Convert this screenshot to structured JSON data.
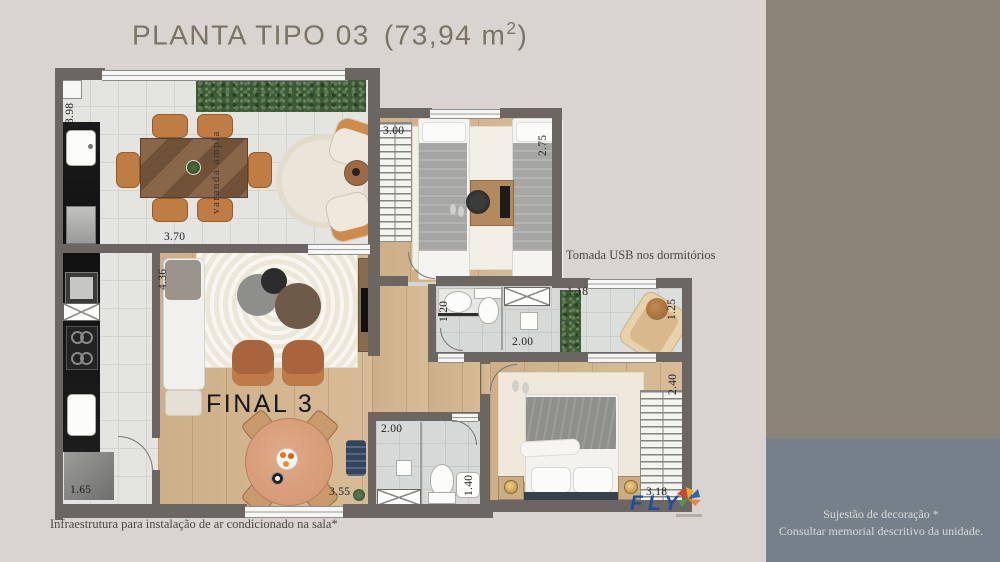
{
  "title": {
    "main": "PLANTA TIPO 03",
    "area_open": "(73,94 m",
    "area_sup": "2",
    "area_close": ")"
  },
  "plan": {
    "final_label": "FINAL 3",
    "varanda_label": "varanda ampla",
    "dimensions": {
      "balcony_height": "3.98",
      "balcony_width": "3.70",
      "bedroom2_width": "3.00",
      "bedroom2_height": "2.75",
      "living_height": "4.36",
      "bath1_height": "1.20",
      "bath1_width": "2.00",
      "terrace_width_top": "1.18",
      "terrace_height": "1.25",
      "bedroom1_height": "2.40",
      "bedroom1_width": "3.18",
      "bath2_width": "2.00",
      "bath2_sink": "1.40",
      "kitchen_width": "1.65",
      "living_width": "3.55"
    }
  },
  "annotations": {
    "usb": "Tomada USB nos dormitórios",
    "ac": "Infraestrutura para instalação de ar condicionado na sala*"
  },
  "side_panel": {
    "line1": "Sujestão de decoração *",
    "line2": "Consultar memorial descritivo da unidade."
  },
  "logo": {
    "text": "FLY"
  },
  "colors": {
    "background": "#d8d5d1",
    "sidebar_taupe": "#8b8378",
    "panel_slate": "#75808b",
    "wall": "#6b6661",
    "wood": "#d0b48e",
    "logo_blue": "#1c4fa3",
    "title_text": "#7a7366"
  }
}
